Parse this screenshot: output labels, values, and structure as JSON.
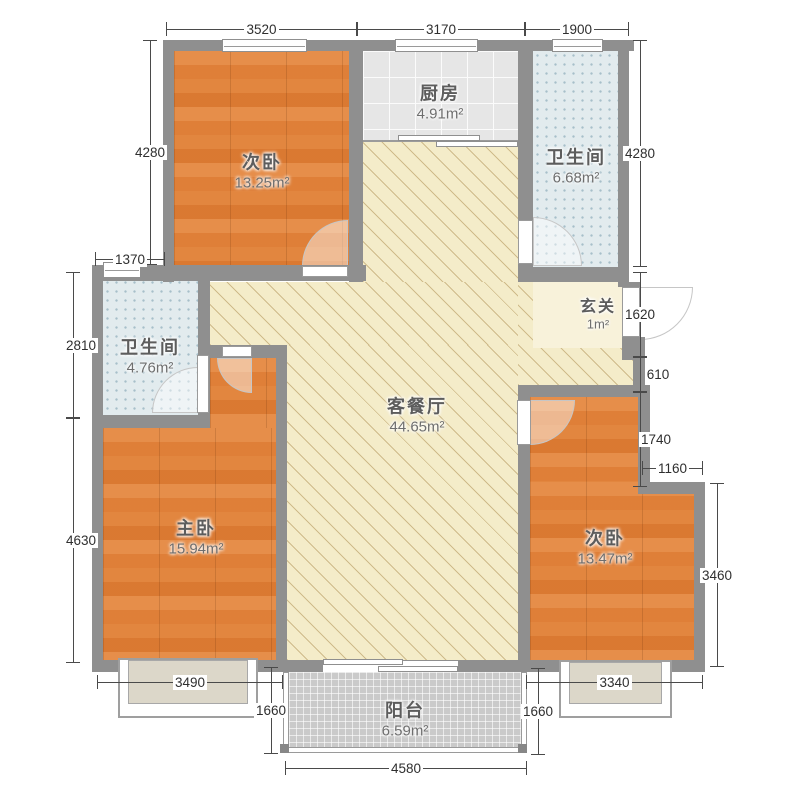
{
  "plan": {
    "rooms": {
      "bedroom_top_left": {
        "name": "次卧",
        "area": "13.25m²"
      },
      "kitchen": {
        "name": "厨房",
        "area": "4.91m²"
      },
      "bath_top_right": {
        "name": "卫生间",
        "area": "6.68m²"
      },
      "entry": {
        "name": "玄关",
        "area": "1m²"
      },
      "bath_left": {
        "name": "卫生间",
        "area": "4.76m²"
      },
      "living_dining": {
        "name": "客餐厅",
        "area": "44.65m²"
      },
      "master_bedroom": {
        "name": "主卧",
        "area": "15.94m²"
      },
      "bedroom_bottom_right": {
        "name": "次卧",
        "area": "13.47m²"
      },
      "balcony": {
        "name": "阳台",
        "area": "6.59m²"
      }
    },
    "dims": {
      "top_3520": "3520",
      "top_3170": "3170",
      "top_1900": "1900",
      "left_4280": "4280",
      "left_1370": "1370",
      "left_2810": "2810",
      "left_4630": "4630",
      "right_4280": "4280",
      "right_1620": "1620",
      "right_610": "610",
      "right_1740": "1740",
      "right_1160": "1160",
      "right_3460": "3460",
      "bottom_3490": "3490",
      "bottom_1660_left": "1660",
      "bottom_4580": "4580",
      "bottom_1660_right": "1660",
      "bottom_3340": "3340"
    },
    "colors": {
      "wall": "#8f8f8f",
      "wood_floor": "#e2843f",
      "living_floor": "#f4ecc9",
      "kitchen_tile": "#e6e6e6",
      "bath_tile": "#e2ebee",
      "balcony_tile": "#cacaca",
      "entry_floor": "#f8f2da"
    }
  }
}
